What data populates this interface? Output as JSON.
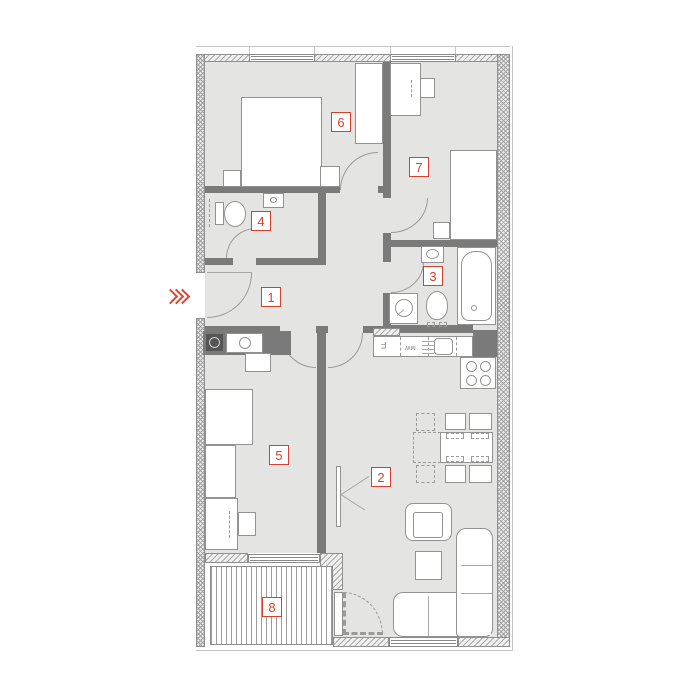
{
  "plan": {
    "rooms": [
      {
        "label": "1"
      },
      {
        "label": "2"
      },
      {
        "label": "3"
      },
      {
        "label": "4"
      },
      {
        "label": "5"
      },
      {
        "label": "6"
      },
      {
        "label": "7"
      },
      {
        "label": "8"
      }
    ],
    "kitchen": {
      "fridge_label": "F",
      "appliance_label": "MW"
    },
    "colors": {
      "accent_red": "#d8402e",
      "wall_gray": "#7a7a7a",
      "floor_gray": "#e4e4e2"
    }
  }
}
